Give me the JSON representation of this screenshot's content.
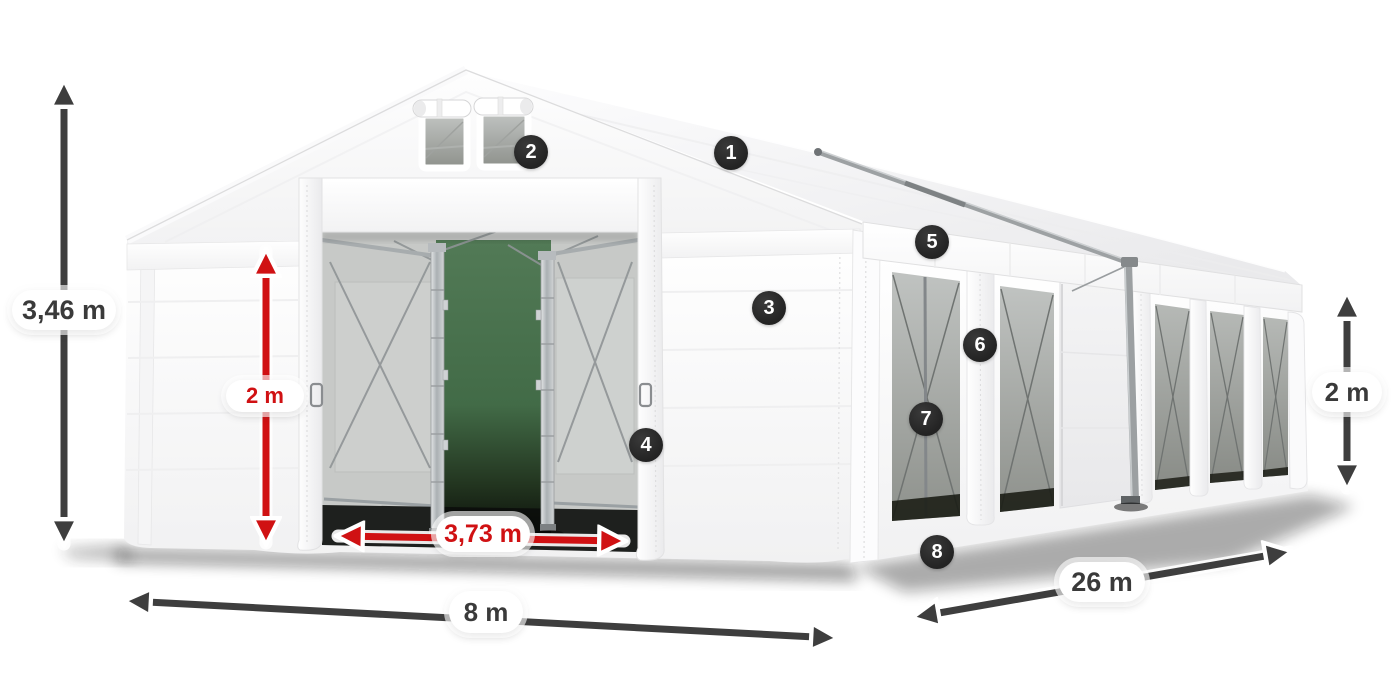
{
  "title": "Tent dimensions diagram",
  "dimensions": {
    "total_height": "3,46 m",
    "door_height": "2 m",
    "door_width": "3,73 m",
    "front_width": "8 m",
    "side_length": "26 m",
    "wall_height": "2 m"
  },
  "markers": [
    "1",
    "2",
    "3",
    "4",
    "5",
    "6",
    "7",
    "8"
  ],
  "colors": {
    "accent_red": "#d01113",
    "arrow_dark": "#3e3e3e",
    "badge_bg": "#282828",
    "pill_bg": "#ffffff",
    "canvas_bg": "#ffffff"
  }
}
